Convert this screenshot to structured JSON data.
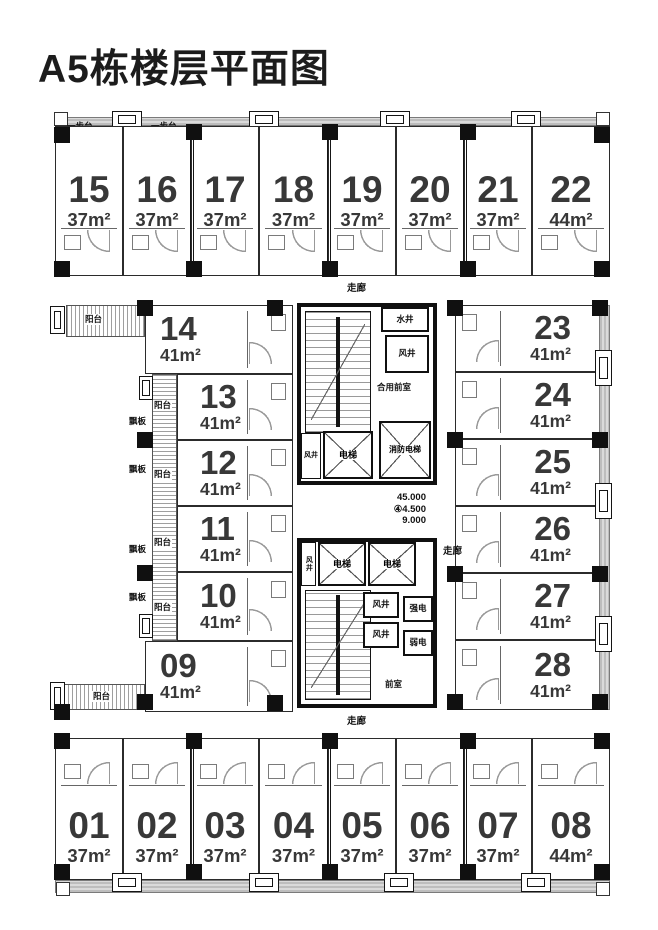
{
  "title": "A5栋楼层平面图",
  "labels": {
    "step_terrace": "一步台",
    "corridor": "走廊",
    "balcony": "阳台",
    "eave_panel": "飘板",
    "water_shaft": "水井",
    "air_shaft": "风井",
    "shared_front_room": "合用前室",
    "elevator": "电梯",
    "fire_elevator": "消防电梯",
    "strong_electric": "强电",
    "weak_electric": "弱电",
    "front_room": "前室"
  },
  "elevations": {
    "l1": "45.000",
    "l2": "④4.500",
    "l3": "9.000"
  },
  "units": {
    "top": [
      {
        "no": "15",
        "area": "37m²"
      },
      {
        "no": "16",
        "area": "37m²"
      },
      {
        "no": "17",
        "area": "37m²"
      },
      {
        "no": "18",
        "area": "37m²"
      },
      {
        "no": "19",
        "area": "37m²"
      },
      {
        "no": "20",
        "area": "37m²"
      },
      {
        "no": "21",
        "area": "37m²"
      },
      {
        "no": "22",
        "area": "44m²"
      }
    ],
    "left": [
      {
        "no": "14",
        "area": "41m²"
      },
      {
        "no": "13",
        "area": "41m²"
      },
      {
        "no": "12",
        "area": "41m²"
      },
      {
        "no": "11",
        "area": "41m²"
      },
      {
        "no": "10",
        "area": "41m²"
      },
      {
        "no": "09",
        "area": "41m²"
      }
    ],
    "right": [
      {
        "no": "23",
        "area": "41m²"
      },
      {
        "no": "24",
        "area": "41m²"
      },
      {
        "no": "25",
        "area": "41m²"
      },
      {
        "no": "26",
        "area": "41m²"
      },
      {
        "no": "27",
        "area": "41m²"
      },
      {
        "no": "28",
        "area": "41m²"
      }
    ],
    "bottom": [
      {
        "no": "01",
        "area": "37m²"
      },
      {
        "no": "02",
        "area": "37m²"
      },
      {
        "no": "03",
        "area": "37m²"
      },
      {
        "no": "04",
        "area": "37m²"
      },
      {
        "no": "05",
        "area": "37m²"
      },
      {
        "no": "06",
        "area": "37m²"
      },
      {
        "no": "07",
        "area": "37m²"
      },
      {
        "no": "08",
        "area": "44m²"
      }
    ]
  }
}
